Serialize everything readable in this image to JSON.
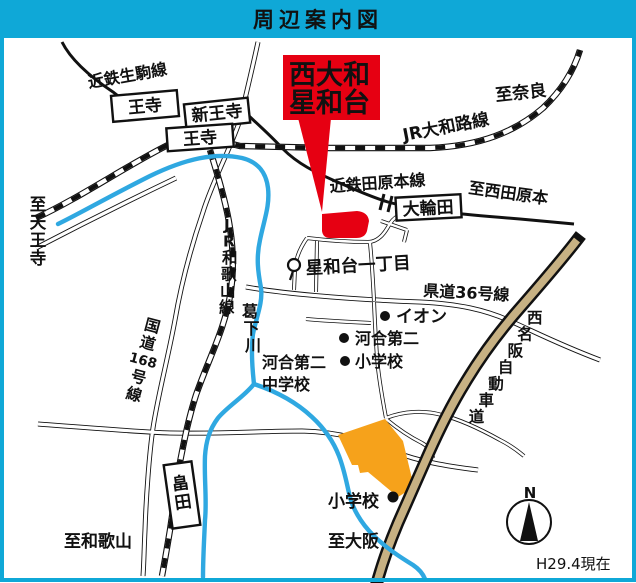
{
  "header": {
    "title": "周辺案内図"
  },
  "colors": {
    "cyan": "#0FA8D7",
    "red": "#E60012",
    "orange": "#F6A21B",
    "river_blue": "#2FA8E1",
    "highway_tan": "#C7B183"
  },
  "callout": {
    "line1": "西大和",
    "line2": "星和台"
  },
  "stations": {
    "oji_kintetsu": "王寺",
    "shin_oji": "新王寺",
    "oji_jr": "王寺",
    "owada": "大輪田",
    "hatada": "畠田"
  },
  "railways": {
    "kintetsu_ikoma": "近鉄生駒線",
    "jr_yamatoji": "JR大和路線",
    "kintetsu_tawaramoto": "近鉄田原本線",
    "jr_wakayama": "JR和歌山線"
  },
  "roads": {
    "route168": {
      "part1": "国道",
      "part2": "168",
      "part3": "号線"
    },
    "kendo36": "県道36号線",
    "nishimeihan": "西名阪自動車道"
  },
  "river": {
    "katsuge": "葛下川"
  },
  "directions": {
    "nara": "至奈良",
    "tennoji": "至天王寺",
    "nishi_tawaramoto": "至西田原本",
    "wakayama": "至和歌山",
    "osaka": "至大阪"
  },
  "places": {
    "seiwadai_1chome": "星和台一丁目",
    "aeon": "イオン",
    "kawai2_elem_line1": "河合第二",
    "kawai2_elem_line2": "小学校",
    "kawai2_jhs_line1": "河合第二",
    "kawai2_jhs_line2": "中学校",
    "elem_school_south": "小学校"
  },
  "compass": {
    "north": "N"
  },
  "footer": {
    "date_note": "H29.4現在"
  }
}
